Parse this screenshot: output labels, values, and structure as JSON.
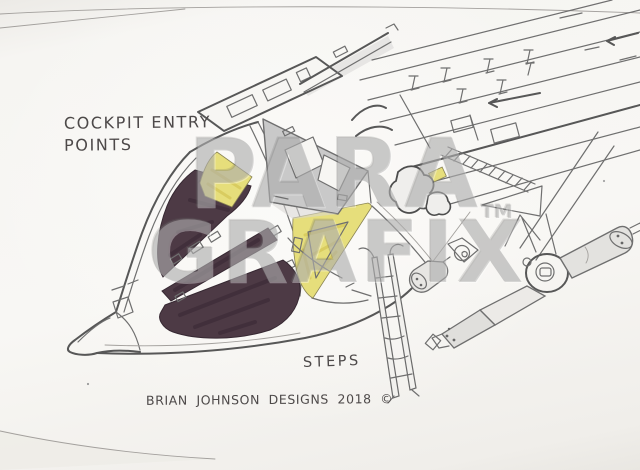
{
  "sketch": {
    "annotations": {
      "cockpit_label_line1": "COCKPIT ENTRY",
      "cockpit_label_line2": "POINTS",
      "steps_label": "STEPS",
      "signature": "BRIAN JOHNSON DESIGNS 2018 ©"
    },
    "watermark": {
      "line1": "PARA",
      "line2": "GRAFIX",
      "trademark": "TM"
    },
    "colors": {
      "paper": "#f6f5f2",
      "pencil": "#6f6f6f",
      "window_tint": "#4d3a45",
      "entry_panel_yellow": "#e6de7b",
      "hatch_gray": "#c9c9c9",
      "watermark_gray": "#8c8c8c"
    }
  }
}
